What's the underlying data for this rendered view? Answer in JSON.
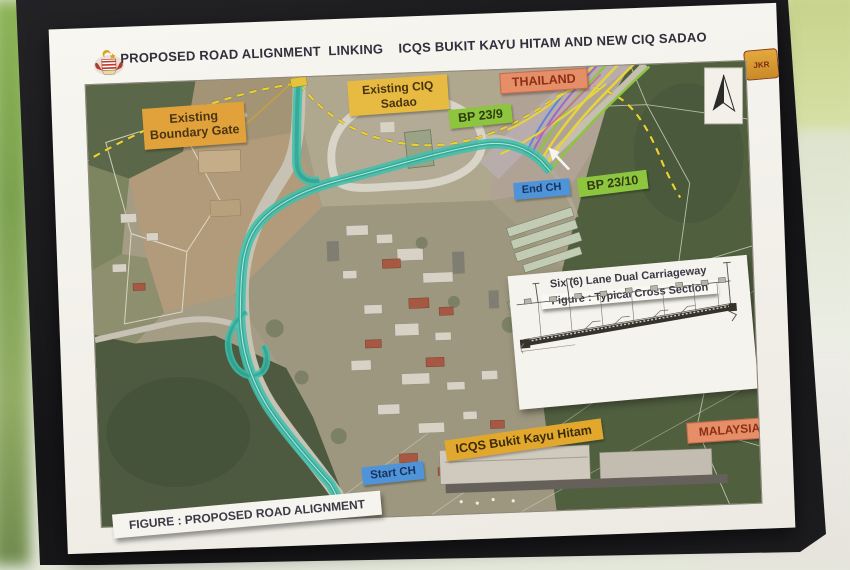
{
  "poster": {
    "title": "PROPOSED ROAD ALIGNMENT  LINKING    ICQS BUKIT KAYU HITAM AND NEW CIQ SADAO",
    "figure_caption": "FIGURE : PROPOSED ROAD ALIGNMENT",
    "jkr_logo": "JKR"
  },
  "map": {
    "labels": {
      "boundary_gate": "Existing Boundary Gate",
      "ciq_sadao": "Existing CIQ Sadao",
      "thailand": "THAILAND",
      "bp_23_9": "BP 23/9",
      "end_ch": "End CH",
      "bp_23_10": "BP 23/10",
      "start_ch": "Start CH",
      "icqs_bkh": "ICQS Bukit Kayu Hitam",
      "malaysia": "MALAYSIA"
    }
  },
  "inset": {
    "title": "Six (6) Lane Dual Carriageway",
    "caption": "Figure : Typical Cross Section"
  },
  "colors": {
    "teal_alignment": "#3fc0ad",
    "border_dash": "#ecd22f",
    "label_orange": "#e2a23b",
    "label_yellow": "#e7bb41",
    "label_salmon": "#e58e68",
    "label_green": "#8dc53f",
    "label_blue": "#4f93d8",
    "label_gold": "#e2a82e",
    "board_black": "#17171a",
    "poster_white": "#f4f2ec"
  }
}
